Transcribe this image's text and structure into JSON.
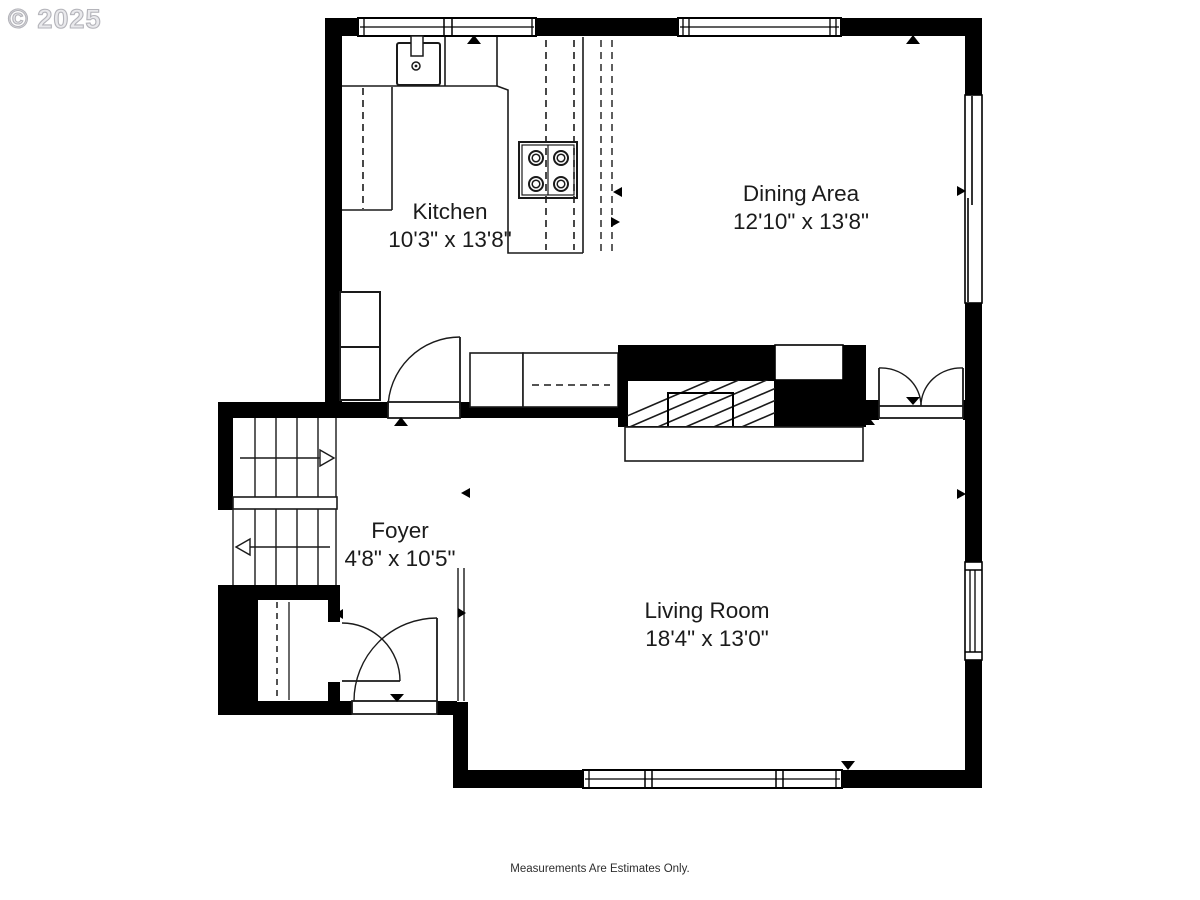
{
  "watermark": {
    "text": "© 2025"
  },
  "rooms": [
    {
      "name": "Kitchen",
      "dimensions": "10'3\" x 13'8\""
    },
    {
      "name": "Dining Area",
      "dimensions": "12'10\" x 13'8\""
    },
    {
      "name": "Foyer",
      "dimensions": "4'8\" x 10'5\""
    },
    {
      "name": "Living Room",
      "dimensions": "18'4\" x 13'0\""
    }
  ],
  "footer": {
    "disclaimer": "Measurements Are Estimates Only."
  },
  "colors": {
    "wall": "#000000",
    "floor": "#ffffff",
    "line": "#1a1a1a",
    "watermark": "#d9d9dd",
    "label_text": "#1b1b1b"
  },
  "fixtures": [
    "sink",
    "stove",
    "refrigerator",
    "fireplace",
    "stairs",
    "closet",
    "entry-door",
    "french-doors"
  ]
}
